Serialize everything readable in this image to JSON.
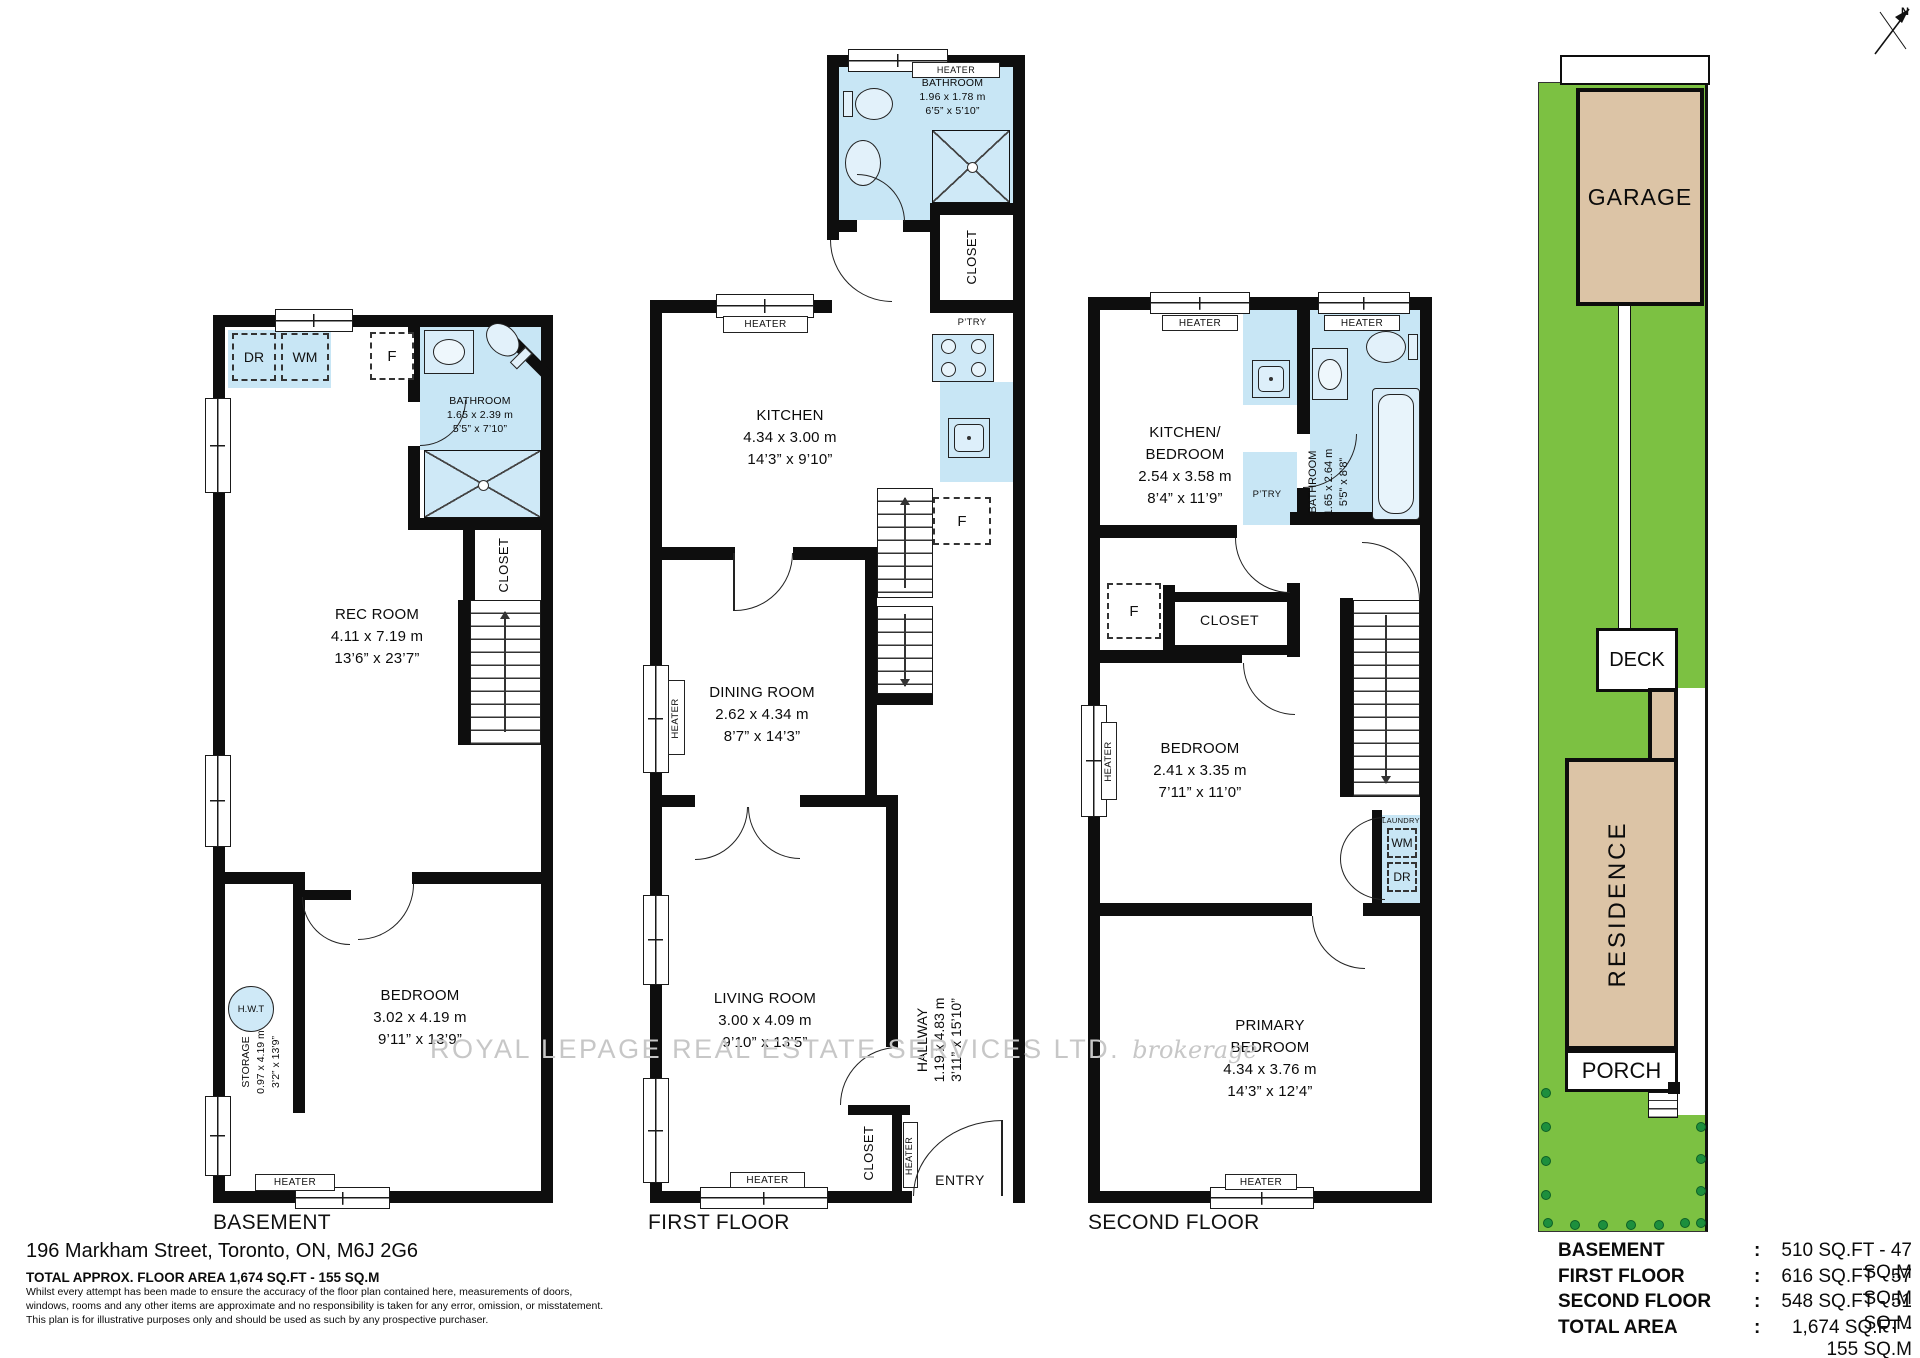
{
  "page": {
    "north_label": "N",
    "watermark_text": "ROYAL LEPAGE REAL ESTATE SERVICES LTD.",
    "watermark_suffix": "brokerage",
    "address": "196 Markham Street, Toronto, ON, M6J 2G6",
    "total_line": "TOTAL APPROX. FLOOR AREA 1,674 SQ.FT - 155 SQ.M",
    "disclaimer1": "Whilst every attempt has been made to ensure the accuracy of the floor plan contained here, measurements of doors,",
    "disclaimer2": "windows, rooms and any other items are approximate and no responsibility is taken for any error, omission, or misstatement.",
    "disclaimer3": "This plan is for illustrative purposes only and should be used as such by any prospective purchaser."
  },
  "labels": {
    "heater": "HEATER",
    "closet": "CLOSET",
    "ptry": "P’TRY",
    "fridge": "F",
    "dryer": "DR",
    "washer": "WM",
    "hwt": "H.W.T",
    "entry": "ENTRY",
    "laundry": "LAUNDRY",
    "basement": "BASEMENT",
    "first": "FIRST FLOOR",
    "second": "SECOND FLOOR"
  },
  "basement": {
    "bathroom": {
      "name": "BATHROOM",
      "m": "1.65 x 2.39 m",
      "ft": "5’5” x 7’10”"
    },
    "rec_room": {
      "name": "REC ROOM",
      "m": "4.11 x 7.19 m",
      "ft": "13’6” x 23’7”"
    },
    "storage": {
      "name": "STORAGE",
      "m": "0.97 x 4.19 m",
      "ft": "3’2” x 13’9”"
    },
    "bedroom": {
      "name": "BEDROOM",
      "m": "3.02 x 4.19 m",
      "ft": "9’11” x 13’9”"
    }
  },
  "first": {
    "bathroom": {
      "name": "BATHROOM",
      "m": "1.96 x 1.78 m",
      "ft": "6’5” x 5’10”"
    },
    "kitchen": {
      "name": "KITCHEN",
      "m": "4.34 x 3.00 m",
      "ft": "14’3” x 9’10”"
    },
    "dining": {
      "name": "DINING ROOM",
      "m": "2.62 x 4.34 m",
      "ft": "8’7” x 14’3”"
    },
    "living": {
      "name": "LIVING ROOM",
      "m": "3.00 x 4.09 m",
      "ft": "9’10” x 13’5”"
    },
    "hallway": {
      "name": "HALLWAY",
      "m": "1.19 x 4.83 m",
      "ft": "3’11” x 15’10”"
    }
  },
  "second": {
    "kitchen_bedroom": {
      "name": "KITCHEN/",
      "name2": "BEDROOM",
      "m": "2.54 x 3.58 m",
      "ft": "8’4” x 11’9”"
    },
    "bathroom": {
      "name": "BATHROOM",
      "m": "1.65 x 2.64 m",
      "ft": "5’5” x 8’8”"
    },
    "bedroom": {
      "name": "BEDROOM",
      "m": "2.41 x 3.35 m",
      "ft": "7’11” x 11’0”"
    },
    "primary": {
      "name": "PRIMARY",
      "name2": "BEDROOM",
      "m": "4.34 x 3.76 m",
      "ft": "14’3” x 12’4”"
    }
  },
  "site": {
    "garage": "GARAGE",
    "deck": "DECK",
    "residence": "RESIDENCE",
    "porch": "PORCH"
  },
  "area_table": {
    "rows": [
      {
        "label": "BASEMENT",
        "sep": ":",
        "value": "510 SQ.FT - 47 SQ.M"
      },
      {
        "label": "FIRST FLOOR",
        "sep": ":",
        "value": "616 SQ.FT - 57 SQ.M"
      },
      {
        "label": "SECOND FLOOR",
        "sep": ":",
        "value": "548 SQ.FT - 51 SQ.M"
      },
      {
        "label": "TOTAL AREA",
        "sep": ":",
        "value": "1,674 SQ.FT - 155 SQ.M"
      }
    ]
  },
  "colors": {
    "wet": "#c8e6f5",
    "lawn": "#7cc142",
    "building": "#dcc4a6",
    "bush": "#1d8f3d",
    "watermark": "#c7c7c7",
    "wall": "#0e0e0e"
  }
}
